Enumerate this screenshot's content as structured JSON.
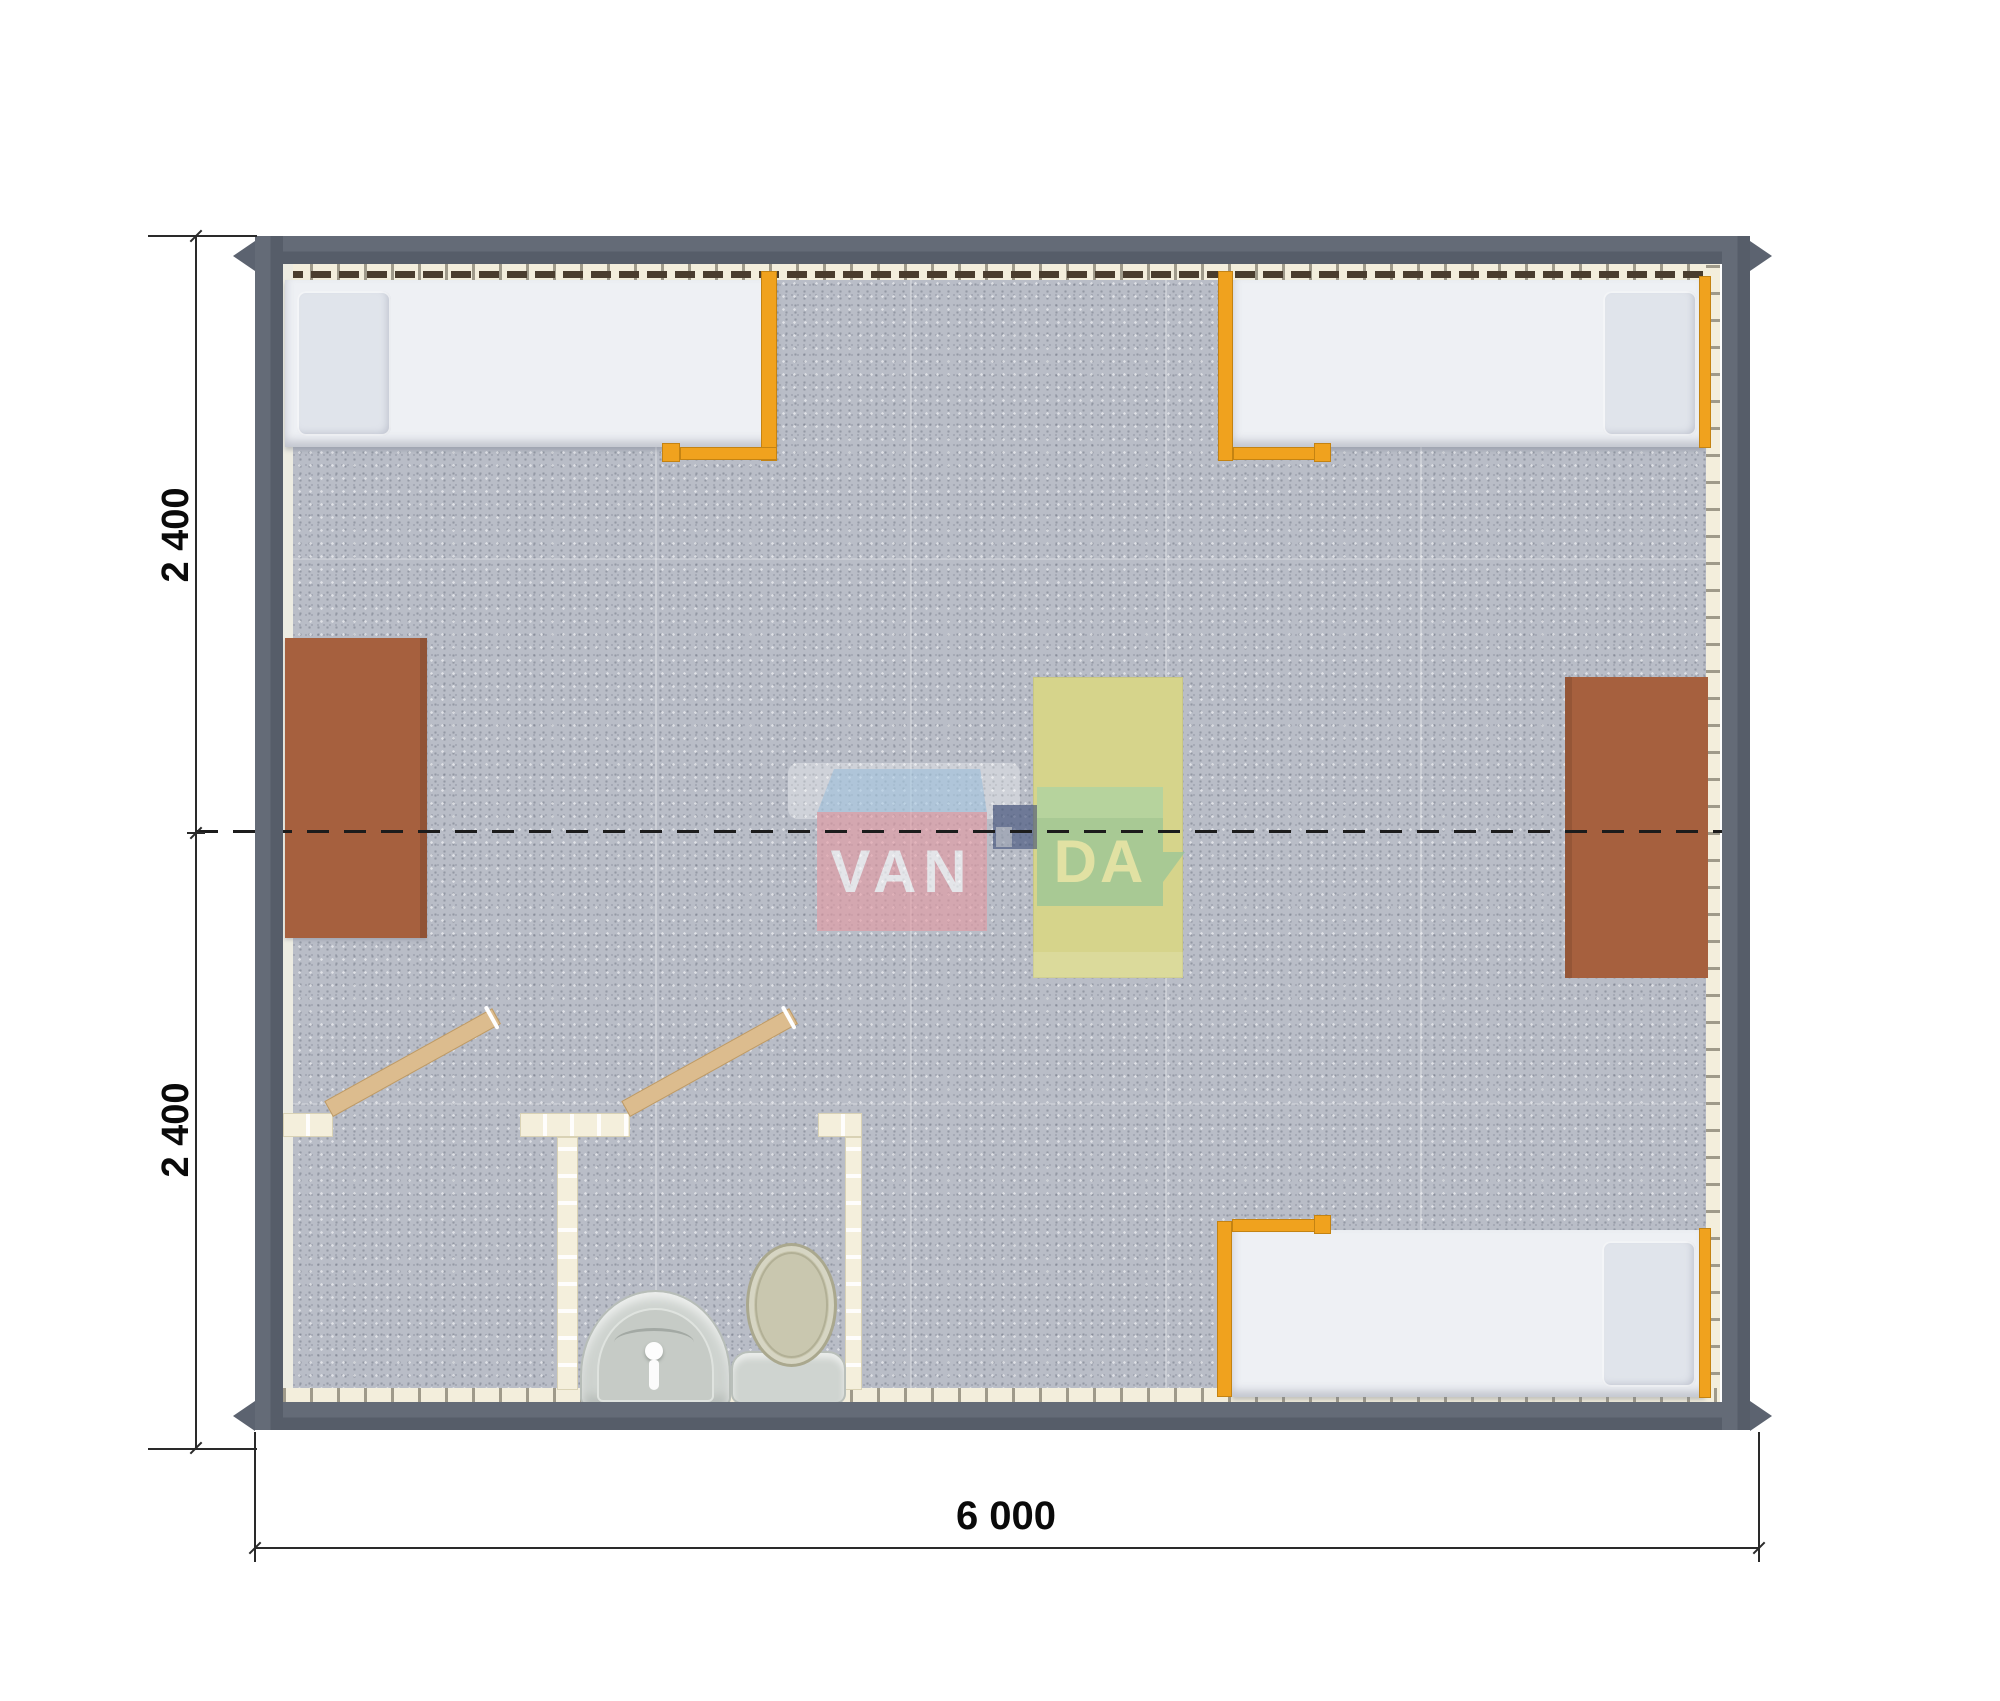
{
  "dimensions": {
    "side_top": "2 400",
    "side_bottom": "2 400",
    "bottom": "6 000"
  },
  "watermark": {
    "left": "VAN",
    "right": "DA"
  },
  "colors": {
    "wall": "#5c6370",
    "lining": "#f3eedc",
    "floor": "#b9bdc7",
    "orange": "#f0a21e",
    "mattress": "#eef0f4",
    "pillow": "#e0e4eb",
    "desk": "#a6603e",
    "table": "#d6d48b",
    "bathwall": "#f4efdc",
    "door": "#dcbc8e",
    "fixture": "#ced3cf",
    "lid": "#c9c7af",
    "pink": "#e59aa3",
    "blue": "#aacbe4",
    "navy": "#41517a",
    "green": "#8cc39b",
    "da": "#e9eab3"
  }
}
